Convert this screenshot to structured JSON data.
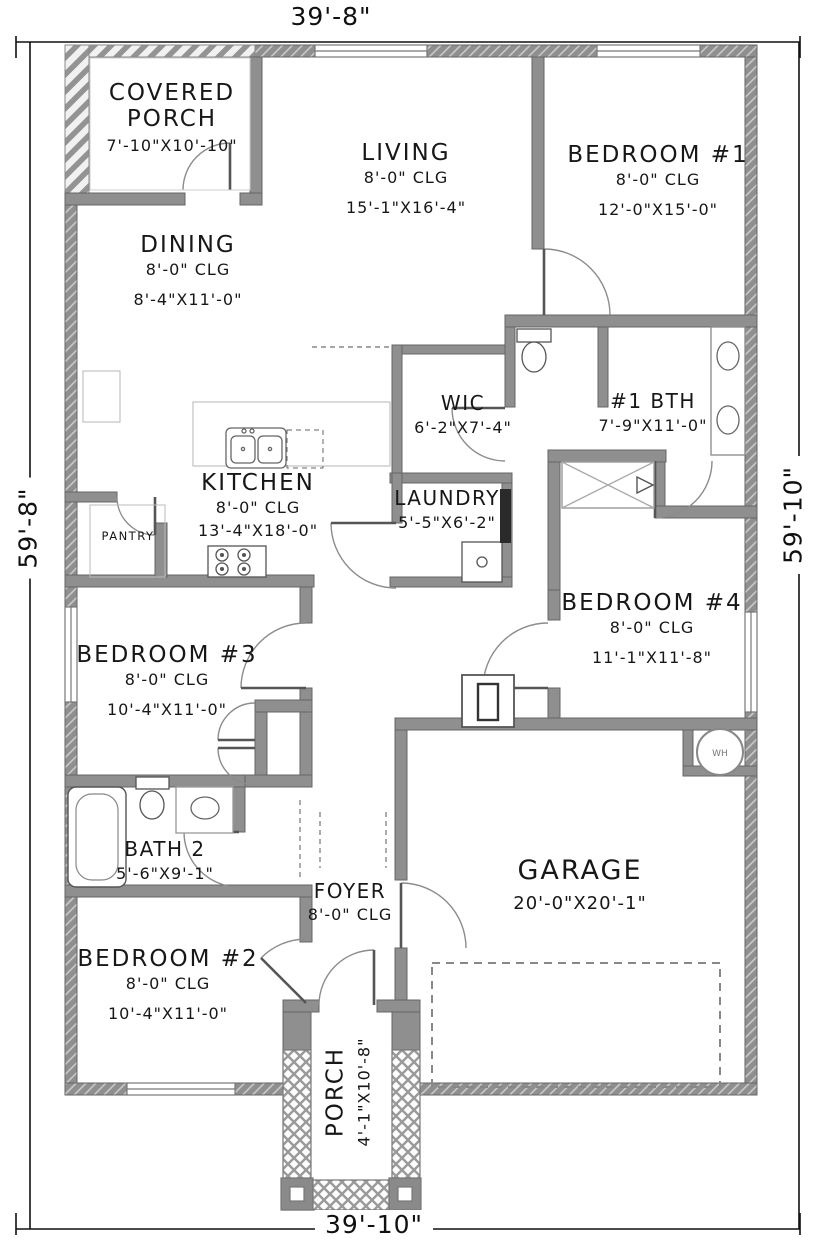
{
  "dimensions": {
    "top": "39'-8\"",
    "bottom": "39'-10\"",
    "left": "59'-8\"",
    "right": "59'-10\""
  },
  "rooms": [
    {
      "id": "covered-porch",
      "name": "COVERED PORCH",
      "clg": "",
      "size": "7'-10\"X10'-10\""
    },
    {
      "id": "living",
      "name": "LIVING",
      "clg": "8'-0\" CLG",
      "size": "15'-1\"X16'-4\""
    },
    {
      "id": "bedroom-1",
      "name": "BEDROOM #1",
      "clg": "8'-0\" CLG",
      "size": "12'-0\"X15'-0\""
    },
    {
      "id": "dining",
      "name": "DINING",
      "clg": "8'-0\" CLG",
      "size": "8'-4\"X11'-0\""
    },
    {
      "id": "wic",
      "name": "WIC",
      "clg": "",
      "size": "6'-2\"X7'-4\""
    },
    {
      "id": "bath-1",
      "name": "#1 BTH",
      "clg": "",
      "size": "7'-9\"X11'-0\""
    },
    {
      "id": "kitchen",
      "name": "KITCHEN",
      "clg": "8'-0\" CLG",
      "size": "13'-4\"X18'-0\""
    },
    {
      "id": "pantry",
      "name": "PANTRY",
      "clg": "",
      "size": ""
    },
    {
      "id": "laundry",
      "name": "LAUNDRY",
      "clg": "",
      "size": "5'-5\"X6'-2\""
    },
    {
      "id": "bedroom-4",
      "name": "BEDROOM #4",
      "clg": "8'-0\" CLG",
      "size": "11'-1\"X11'-8\""
    },
    {
      "id": "bedroom-3",
      "name": "BEDROOM #3",
      "clg": "8'-0\" CLG",
      "size": "10'-4\"X11'-0\""
    },
    {
      "id": "bath-2",
      "name": "BATH 2",
      "clg": "",
      "size": "5'-6\"X9'-1\""
    },
    {
      "id": "foyer",
      "name": "FOYER",
      "clg": "8'-0\" CLG",
      "size": ""
    },
    {
      "id": "bedroom-2",
      "name": "BEDROOM #2",
      "clg": "8'-0\" CLG",
      "size": "10'-4\"X11'-0\""
    },
    {
      "id": "garage",
      "name": "GARAGE",
      "clg": "",
      "size": "20'-0\"X20'-1\""
    },
    {
      "id": "porch",
      "name": "PORCH",
      "clg": "",
      "size": "4'-1\"X10'-8\""
    }
  ],
  "fixtures": {
    "water_heater": "WH"
  },
  "colors": {
    "wall": "#8f8f8f",
    "line": "#171717"
  }
}
